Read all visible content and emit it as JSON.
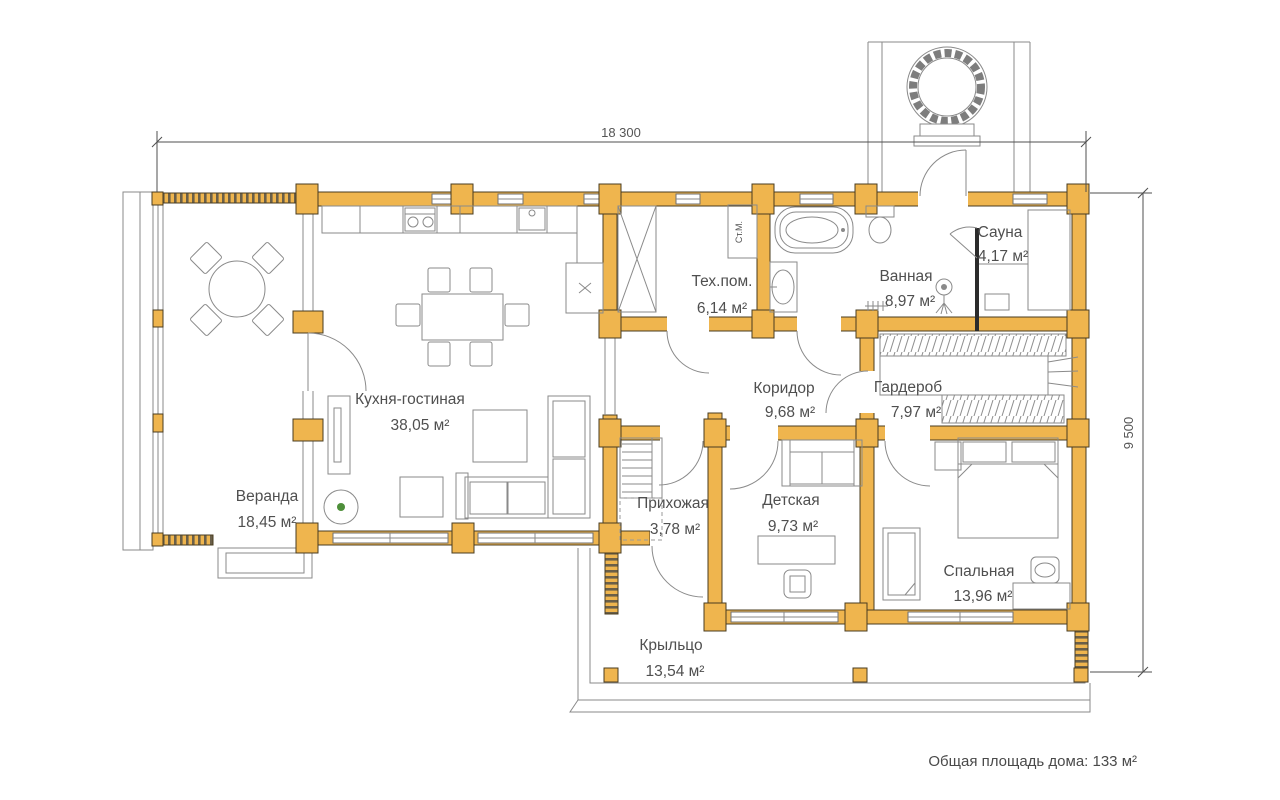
{
  "plan": {
    "note_total_area": "Общая площадь дома: 133 м²",
    "dimensions": {
      "width": "18 300",
      "depth": "9 500"
    },
    "rooms": {
      "veranda": {
        "name": "Веранда",
        "area": "18,45 м²"
      },
      "kitchen_living": {
        "name": "Кухня-гостиная",
        "area": "38,05 м²"
      },
      "utility": {
        "name": "Тех.пом.",
        "area": "6,14 м²"
      },
      "bathroom": {
        "name": "Ванная",
        "area": "8,97 м²"
      },
      "sauna": {
        "name": "Сауна",
        "area": "4,17 м²"
      },
      "corridor": {
        "name": "Коридор",
        "area": "9,68 м²"
      },
      "wardrobe": {
        "name": "Гардероб",
        "area": "7,97 м²"
      },
      "hallway": {
        "name": "Прихожая",
        "area": "3,78 м²"
      },
      "kids_room": {
        "name": "Детская",
        "area": "9,73 м²"
      },
      "bedroom": {
        "name": "Спальная",
        "area": "13,96 м²"
      },
      "porch": {
        "name": "Крыльцо",
        "area": "13,54 м²"
      }
    },
    "labels": {
      "washing_machine": "Ст.М."
    },
    "colors": {
      "wall_fill": "#EFB54E",
      "wall_stroke": "#4A3C20",
      "line_gray": "#8A8A8A",
      "text": "#4F4F4F"
    }
  }
}
